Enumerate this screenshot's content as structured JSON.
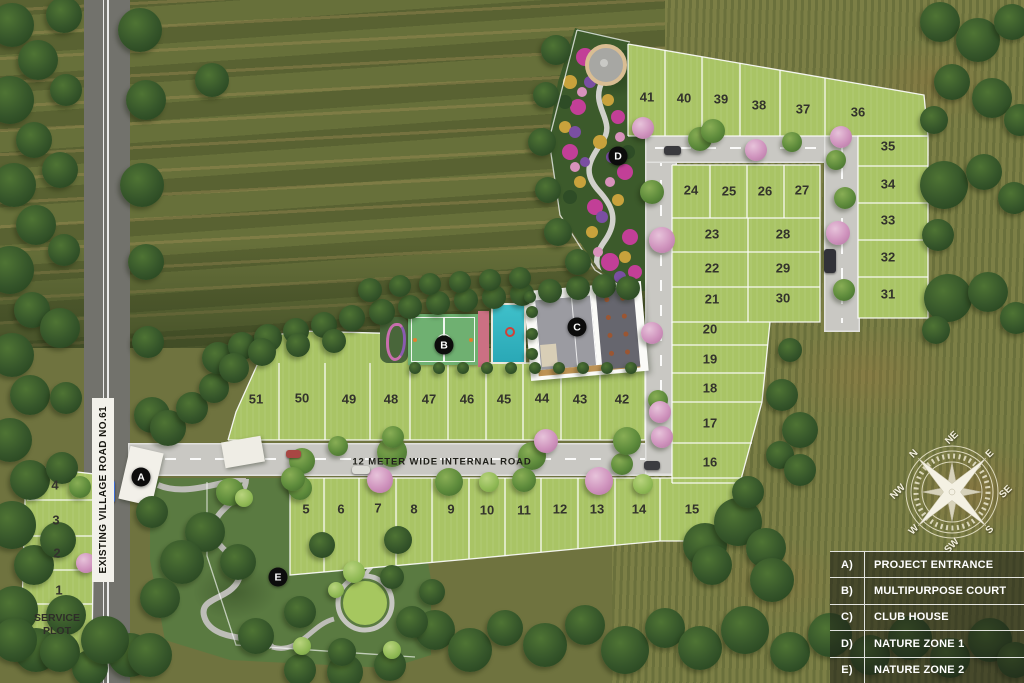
{
  "legend": {
    "items": [
      {
        "key": "A)",
        "label": "PROJECT ENTRANCE"
      },
      {
        "key": "B)",
        "label": "MULTIPURPOSE COURT"
      },
      {
        "key": "C)",
        "label": "CLUB HOUSE"
      },
      {
        "key": "D)",
        "label": "NATURE ZONE 1"
      },
      {
        "key": "E)",
        "label": "NATURE ZONE 2"
      }
    ]
  },
  "roads": {
    "village_road_label": "EXISTING VILLAGE ROAD NO.61",
    "internal_road_label": "12 METER WIDE INTERNAL ROAD"
  },
  "plots": {
    "numbers": [
      1,
      2,
      3,
      4,
      5,
      6,
      7,
      8,
      9,
      10,
      11,
      12,
      13,
      14,
      15,
      16,
      17,
      18,
      19,
      20,
      21,
      22,
      23,
      24,
      25,
      26,
      27,
      28,
      29,
      30,
      31,
      32,
      33,
      34,
      35,
      36,
      37,
      38,
      39,
      40,
      41,
      42,
      43,
      44,
      45,
      46,
      47,
      48,
      49,
      50,
      51
    ]
  },
  "service_plot": {
    "line1": "SERVICE",
    "line2": "PLOT"
  },
  "markers": [
    {
      "letter": "A"
    },
    {
      "letter": "B"
    },
    {
      "letter": "C"
    },
    {
      "letter": "D"
    },
    {
      "letter": "E"
    }
  ],
  "compass": {
    "directions": [
      "N",
      "NE",
      "E",
      "SE",
      "S",
      "SW",
      "W",
      "NW"
    ]
  },
  "colors": {
    "plot_green": "#a9c465",
    "road_gray": "#c9c8c3",
    "village_road_gray": "#72726c",
    "pool_teal": "#35b9c4",
    "court_green": "#6fb071",
    "court_trim_pink": "#cb7083",
    "flower_magenta": "#c23f97",
    "marker_black": "#0c0c0c",
    "legend_bg": "rgba(28,30,22,0.55)",
    "boundary_white": "#ffffff"
  }
}
